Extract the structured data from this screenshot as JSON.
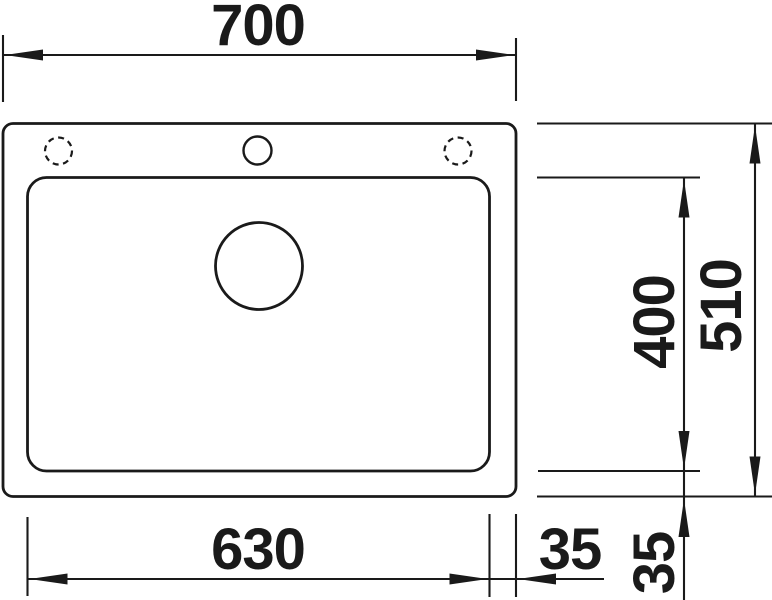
{
  "drawing": {
    "colors": {
      "line": "#1a1a1a",
      "background": "#ffffff"
    },
    "dimensions": {
      "overall_width_mm": "700",
      "overall_depth_mm": "510",
      "bowl_depth_mm": "400",
      "bowl_width_mm": "630",
      "right_offset_mm": "35",
      "bottom_offset_mm": "35"
    }
  }
}
